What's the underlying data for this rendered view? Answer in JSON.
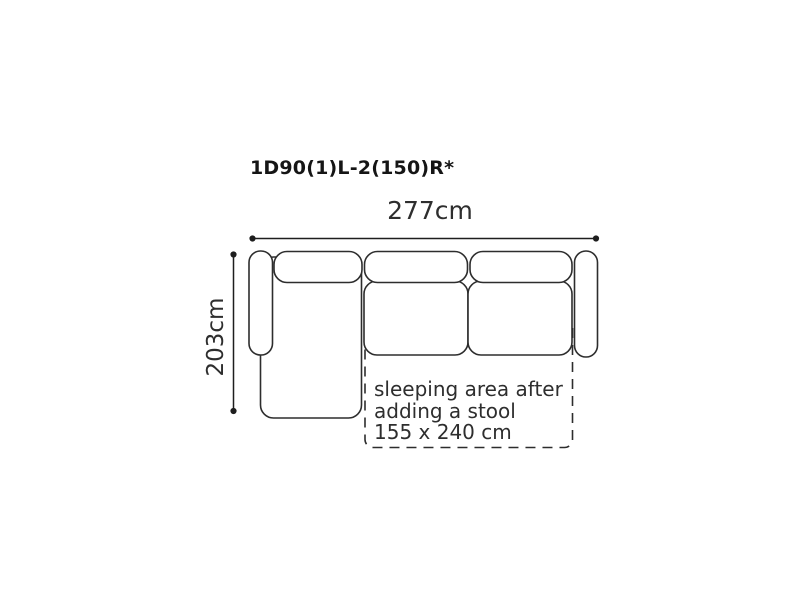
{
  "diagram": {
    "product_code": "1D90(1)L-2(150)R*",
    "width_label": "277cm",
    "depth_label": "203cm",
    "sleeping_area_note": {
      "lines": [
        "sleeping area after",
        "adding a stool",
        "155 x 240 cm"
      ]
    },
    "colors": {
      "background": "#ffffff",
      "outline": "#2d2d2d",
      "dimension": "#1e1e1e",
      "text": "#2e2e2e",
      "title": "#151515"
    }
  }
}
